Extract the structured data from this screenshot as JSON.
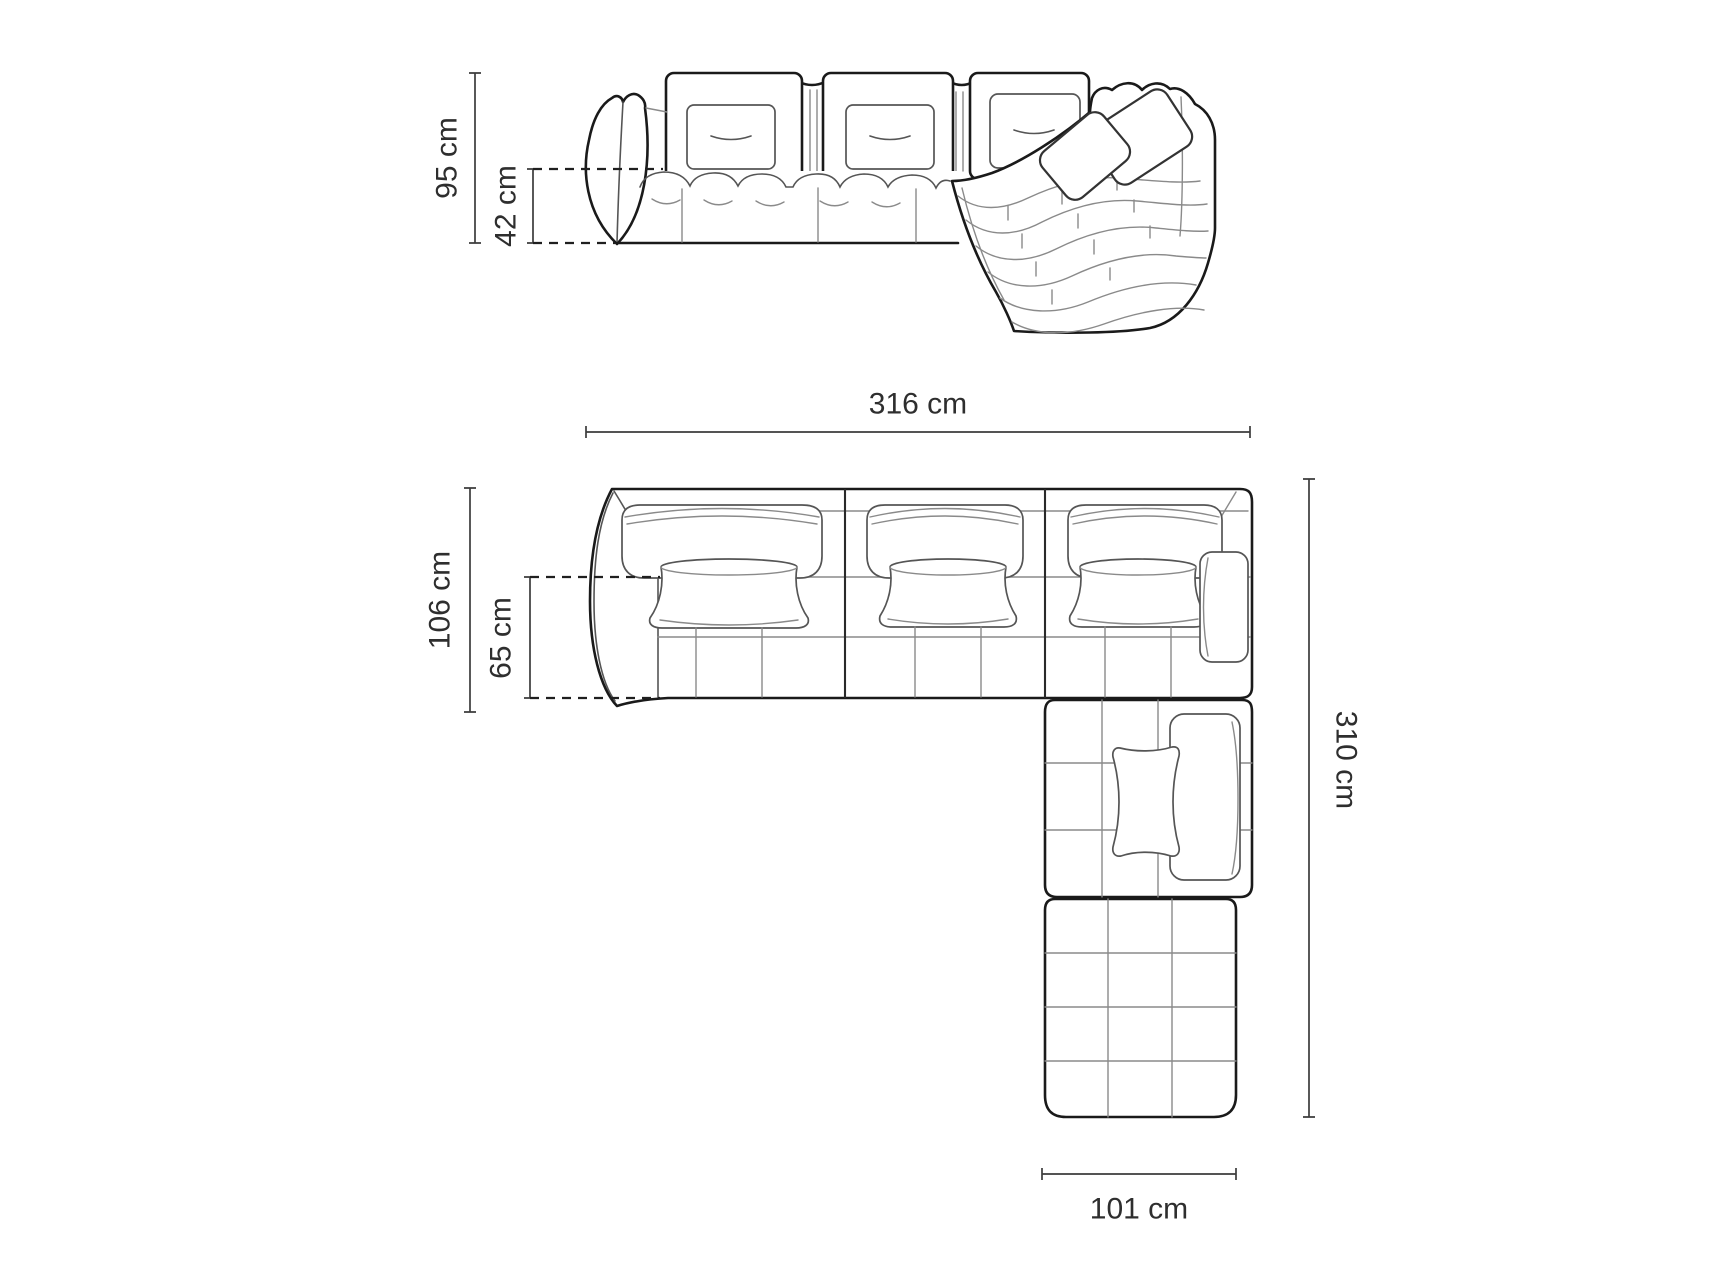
{
  "diagram": {
    "type": "furniture-dimension-drawing",
    "subject": "modular corner sofa with chaise, front elevation and top plan views",
    "views": {
      "front": {
        "name": "front-elevation",
        "dimensions": [
          {
            "id": "total_height",
            "value": 95,
            "unit": "cm",
            "label": "95 cm"
          },
          {
            "id": "seat_height",
            "value": 42,
            "unit": "cm",
            "label": "42 cm"
          }
        ]
      },
      "plan": {
        "name": "top-plan",
        "dimensions": [
          {
            "id": "total_width",
            "value": 316,
            "unit": "cm",
            "label": "316 cm"
          },
          {
            "id": "total_depth",
            "value": 106,
            "unit": "cm",
            "label": "106 cm"
          },
          {
            "id": "seat_depth",
            "value": 65,
            "unit": "cm",
            "label": "65 cm"
          },
          {
            "id": "total_length",
            "value": 310,
            "unit": "cm",
            "label": "310 cm"
          },
          {
            "id": "chaise_width",
            "value": 101,
            "unit": "cm",
            "label": "101 cm"
          }
        ]
      }
    },
    "colors": {
      "background": "#ffffff",
      "outline": "#1a1a1a",
      "detail": "#8a8a8a",
      "dimension_line": "#3c3c3c",
      "text": "#2e2e2e"
    }
  }
}
